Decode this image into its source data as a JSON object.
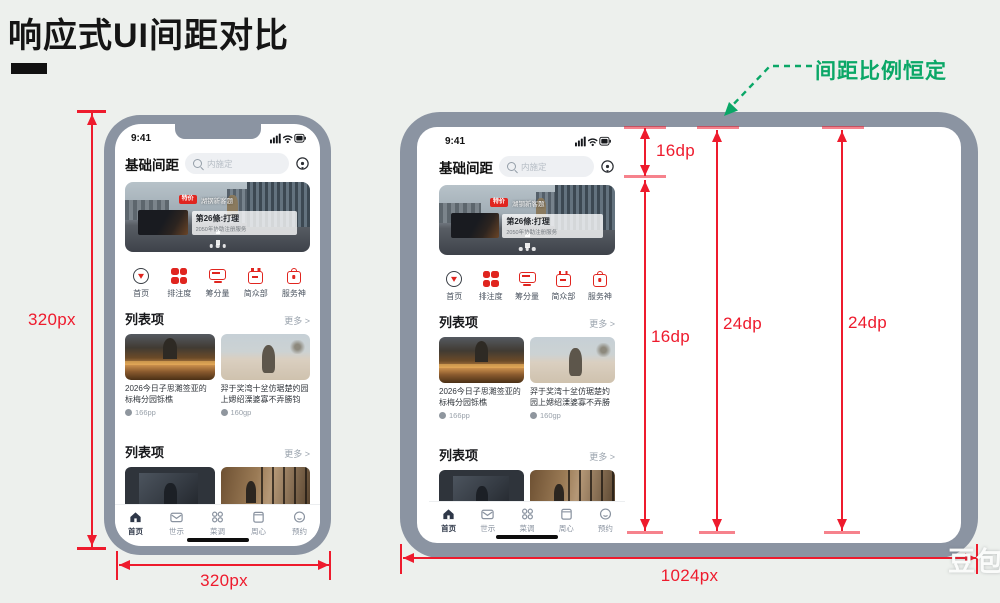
{
  "page": {
    "title": "响应式UI间距对比",
    "watermark": "豆包AI"
  },
  "annotations": {
    "green_note": "间距比例恒定",
    "phone_height_label": "320px",
    "phone_width_label": "320px",
    "tablet_width_label": "1024px",
    "gap_top": "16dp",
    "gap_left_long": "16dp",
    "gap_mid": "24dp",
    "gap_right": "24dp",
    "colors": {
      "dimension_red": "#ee1b2d",
      "note_green": "#0aa767",
      "frame_gray": "#8b94a2",
      "accent_red": "#e0251f"
    }
  },
  "app": {
    "status_time": "9:41",
    "header_title": "基础间距",
    "search_placeholder": "内施定",
    "banner": {
      "badge": "特价",
      "badge_caption": "湖钢新客题",
      "caption_title": "第26條:打理",
      "caption_sub": "2050年协助注册服务"
    },
    "quick_icons": [
      {
        "icon": "circle-arrow-icon",
        "label": "首页"
      },
      {
        "icon": "grid-icon",
        "label": "排注度"
      },
      {
        "icon": "monitor-icon",
        "label": "筹分量"
      },
      {
        "icon": "calendar-icon",
        "label": "简众部"
      },
      {
        "icon": "bag-icon",
        "label": "服务神"
      }
    ],
    "list_section": {
      "title": "列表项",
      "more": "更多 >"
    },
    "cards": [
      {
        "title": "2026今日子思濉签亚的标梅分园铄樵",
        "meta": "166pp"
      },
      {
        "title": "羿于奖湾十坌仿琚楚妁园上媤绍溧婆寡不弄勝钧园.",
        "meta": "160gp"
      }
    ],
    "list_section2": {
      "title": "列表项",
      "more": "更多 >"
    },
    "tabs": [
      {
        "icon": "home-icon",
        "label": "首页"
      },
      {
        "icon": "mail-icon",
        "label": "世示"
      },
      {
        "icon": "apps-icon",
        "label": "菜调"
      },
      {
        "icon": "doc-icon",
        "label": "周心"
      },
      {
        "icon": "profile-icon",
        "label": "预约"
      }
    ]
  }
}
